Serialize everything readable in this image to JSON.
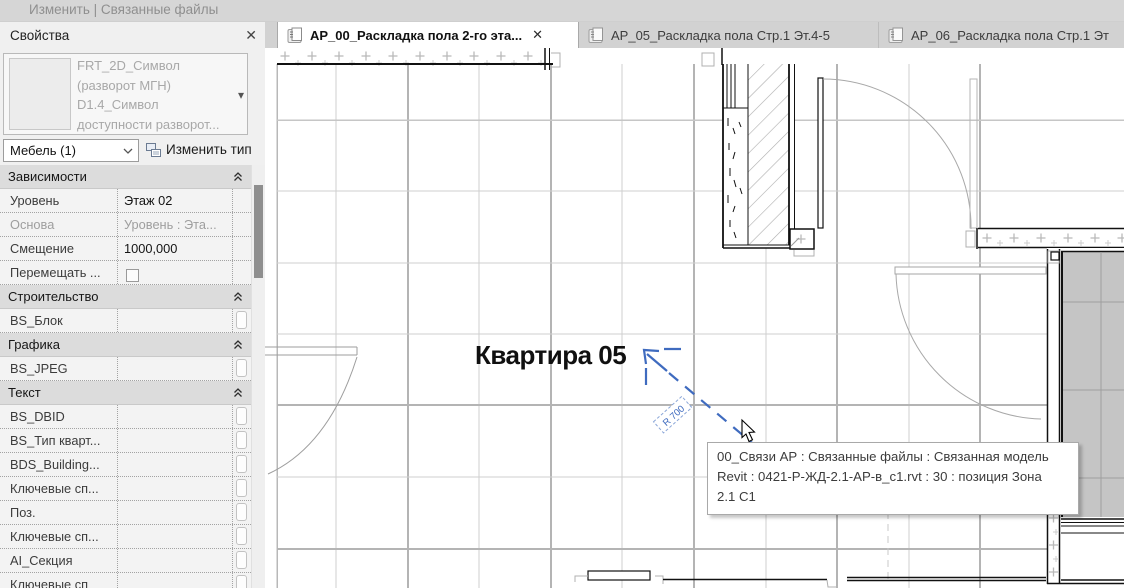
{
  "topbar": {
    "mode_label": "Изменить | Связанные файлы"
  },
  "icons": {
    "close": "✕",
    "tab_close": "✕",
    "dropdown_arrow": "▾"
  },
  "properties_panel": {
    "title": "Свойства",
    "type_selector": {
      "lines": [
        "FRT_2D_Символ",
        "(разворот МГН)",
        "D1.4_Символ",
        "доступности разворот..."
      ]
    },
    "category_selector": {
      "value": "Мебель (1)"
    },
    "edit_type_button": {
      "label": "Изменить тип"
    },
    "rows": [
      {
        "kind": "section",
        "label": "Зависимости"
      },
      {
        "kind": "prop",
        "label": "Уровень",
        "value": "Этаж 02"
      },
      {
        "kind": "prop",
        "label": "Основа",
        "value": "Уровень : Эта...",
        "disabled": true
      },
      {
        "kind": "prop",
        "label": "Смещение",
        "value": "1000,000"
      },
      {
        "kind": "prop",
        "label": "Перемещать ...",
        "value": "",
        "checkbox": true
      },
      {
        "kind": "section",
        "label": "Строительство"
      },
      {
        "kind": "prop",
        "label": "BS_Блок",
        "value": "",
        "button": true
      },
      {
        "kind": "section",
        "label": "Графика"
      },
      {
        "kind": "prop",
        "label": "BS_JPEG",
        "value": "",
        "button": true
      },
      {
        "kind": "section",
        "label": "Текст"
      },
      {
        "kind": "prop",
        "label": "BS_DBID",
        "value": "",
        "button": true
      },
      {
        "kind": "prop",
        "label": "BS_Тип кварт...",
        "value": "",
        "button": true
      },
      {
        "kind": "prop",
        "label": "BDS_Building...",
        "value": "",
        "button": true
      },
      {
        "kind": "prop",
        "label": "Ключевые сп...",
        "value": "",
        "button": true
      },
      {
        "kind": "prop",
        "label": "Поз.",
        "value": "",
        "button": true
      },
      {
        "kind": "prop",
        "label": "Ключевые сп...",
        "value": "",
        "button": true
      },
      {
        "kind": "prop",
        "label": "AI_Секция",
        "value": "",
        "button": true
      },
      {
        "kind": "prop",
        "label": "Ключевые сп",
        "value": "",
        "button": true
      }
    ]
  },
  "view_tabs": [
    {
      "label": "АР_00_Раскладка пола 2-го эта...",
      "active": true,
      "closable": true
    },
    {
      "label": "АР_05_Раскладка пола Стр.1 Эт.4-5",
      "active": false
    },
    {
      "label": "АР_06_Раскладка пола Стр.1 Эт",
      "active": false
    }
  ],
  "canvas": {
    "room_label": "Квартира 05",
    "radius_label": "R 700",
    "tooltip": {
      "lines": [
        "00_Связи АР : Связанные файлы : Связанная модель",
        "Revit : 0421-Р-ЖД-2.1-АР-в_с1.rvt : 30 : позиция Зона",
        "2.1 С1"
      ]
    }
  },
  "colors": {
    "selection_blue": "#3f6bbf",
    "tile_fill": "#c5c5c5",
    "wall_black": "#111111",
    "tooltip_border": "#a9a9a9"
  }
}
